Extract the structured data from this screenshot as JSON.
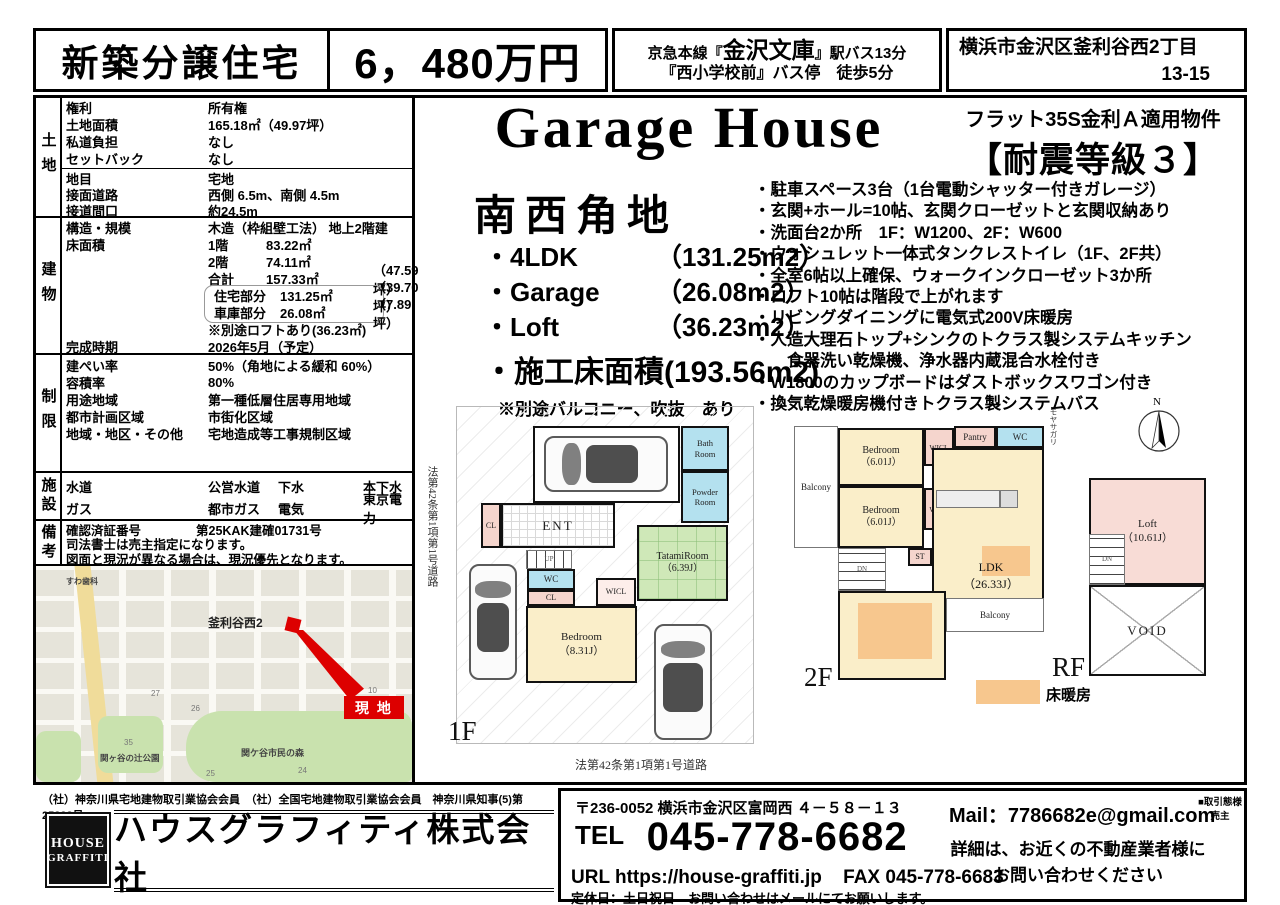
{
  "colors": {
    "accent_red": "#dd0000",
    "floor_heating_orange": "#f7c78e",
    "tatami_green": "#cfe8b8",
    "water_blue": "#b4e1ef",
    "closet_pink": "#f5d5cd",
    "loft_pink": "#f8dcd6"
  },
  "header": {
    "type_label": "新築分譲住宅",
    "price": "6，480万円",
    "access_pre": "京急本線『",
    "access_station": "金沢文庫",
    "access_post": "』駅バス13分",
    "access_line2": "『西小学校前』バス停　徒歩5分",
    "address_line1": "横浜市金沢区釜利谷西2丁目",
    "address_line2": "13-15"
  },
  "table": {
    "land": {
      "group": "土地",
      "rows": [
        {
          "label": "権利",
          "value": "所有権"
        },
        {
          "label": "土地面積",
          "value": "165.18㎡（49.97坪）"
        },
        {
          "label": "私道負担",
          "value": "なし"
        },
        {
          "label": "セットバック",
          "value": "なし"
        }
      ],
      "rows2": [
        {
          "label": "地目",
          "value": "宅地"
        },
        {
          "label": "接面道路",
          "value": "西側 6.5m、南側 4.5m"
        },
        {
          "label": "接道間口",
          "value": "約24.5m"
        }
      ]
    },
    "building": {
      "group": "建物",
      "rows": [
        {
          "label": "構造・規模",
          "value": "木造（枠組壁工法） 地上2階建"
        },
        {
          "label": "床面積",
          "sub": "1階",
          "value": "83.22㎡"
        },
        {
          "sub": "2階",
          "value": "74.11㎡"
        },
        {
          "sub": "合計",
          "value": "157.33㎡",
          "tsubo": "（47.59坪）"
        },
        {
          "sub": "住宅部分",
          "value": "131.25㎡",
          "tsubo": "（39.70坪）"
        },
        {
          "sub": "車庫部分",
          "value": "26.08㎡",
          "tsubo": "（7.89坪）"
        },
        {
          "value": "※別途ロフトあり(36.23㎡)"
        },
        {
          "label": "完成時期",
          "value": "2026年5月（予定）"
        }
      ]
    },
    "restrict": {
      "group": "制限",
      "rows": [
        {
          "label": "建ぺい率",
          "value": "50%（角地による緩和 60%）"
        },
        {
          "label": "容積率",
          "value": "80%"
        },
        {
          "label": "用途地域",
          "value": "第一種低層住居専用地域"
        },
        {
          "label": "都市計画区域",
          "value": "市街化区域"
        },
        {
          "label": "地域・地区・その他",
          "value": "宅地造成等工事規制区域"
        }
      ]
    },
    "facility": {
      "group": "施設",
      "rows": [
        {
          "l1": "水道",
          "v1": "公営水道",
          "l2": "下水",
          "v2": "本下水"
        },
        {
          "l1": "ガス",
          "v1": "都市ガス",
          "l2": "電気",
          "v2": "東京電力"
        }
      ]
    },
    "remarks": {
      "group": "備考",
      "cert_label": "確認済証番号",
      "cert_value": "第25KAK建確01731号",
      "line2": "司法書士は売主指定になります。",
      "line3": "図面と現況が異なる場合は、現況優先となります。"
    }
  },
  "map": {
    "dental": "すわ歯科",
    "district": "釜利谷西2",
    "site": "現 地",
    "park1": "関ヶ谷の辻公園",
    "park2": "関ケ谷市民の森",
    "n27": "27",
    "n26": "26",
    "n25": "25",
    "n24": "24",
    "n35": "35",
    "n10": "10"
  },
  "main": {
    "title": "Garage House",
    "corner": "南西角地",
    "specs": [
      {
        "name": "・4LDK",
        "area": "（131.25m2）"
      },
      {
        "name": "・Garage",
        "area": "（26.08m2）"
      },
      {
        "name": "・Loft",
        "area": "（36.23m2）"
      }
    ],
    "total": "・施工床面積(193.56m2)",
    "note": "※別途バルコニー、吹抜　あり",
    "flat35": "フラット35S金利Ａ適用物件",
    "seismic": "【耐震等級３】",
    "features": [
      "・駐車スペース3台（1台電動シャッター付きガレージ）",
      "・玄関+ホール=10帖、玄関クローゼットと玄関収納あり",
      "・洗面台2か所　1F：W1200、2F：W600",
      "・ウォシュレット一体式タンクレストイレ（1F、2F共）",
      "・全室6帖以上確保、ウォークインクローゼット3か所",
      "・ロフト10帖は階段で上がれます",
      "・リビングダイニングに電気式200V床暖房",
      "・人造大理石トップ+シンクのトクラス製システムキッチン",
      "　　食器洗い乾燥機、浄水器内蔵混合水栓付き",
      "・W1800のカップボードはダストボックスワゴン付き",
      "・換気乾燥暖房機付きトクラス製システムバス"
    ]
  },
  "plans": {
    "road_left": "法第42条第1項第1号道路",
    "road_bottom": "法第42条第1項第1号道路",
    "f1": "1F",
    "f2": "2F",
    "rf": "RF",
    "legend": "床暖房",
    "moyasagari": "モヤサガリ",
    "north": "N",
    "r1f": {
      "bath": "Bath\nRoom",
      "powder": "Powder\nRoom",
      "cl1": "CL",
      "ent": "ENT",
      "up": "UP",
      "wc": "WC",
      "cl2": "CL",
      "wicl": "WICL",
      "st": "ST",
      "tatami": "TatamiRoom\n（6.39J）",
      "bedroom": "Bedroom\n（8.31J）"
    },
    "r2f": {
      "balcony1": "Balcony",
      "bedroom1": "Bedroom\n（6.01J）",
      "wicl1": "WICL",
      "pantry": "Pantry",
      "wc": "WC",
      "bedroom2": "Bedroom\n（6.01J）",
      "wicl2": "WICL",
      "st": "ST",
      "ldk": "LDK\n（26.33J）",
      "balcony2": "Balcony",
      "up": "UP",
      "dn": "DN"
    },
    "rrf": {
      "loft": "Loft\n（10.61J）",
      "void": "VOID",
      "dn": "DN"
    }
  },
  "footer": {
    "memberships": "（社）神奈川県宅地建物取引業協会会員　（社）全国宅地建物取引業協会会員　神奈川県知事(5)第25238号",
    "logo1": "HOUSE",
    "logo2": "GRAFFITI",
    "company": "ハウスグラフィティ株式会社",
    "postal": "〒236-0052 横浜市金沢区富岡西 ４－５８－１３",
    "tel_label": "TEL",
    "tel": "045-778-6682",
    "url": "URL https://house-graffiti.jp",
    "fax": "FAX 045-778-6683",
    "holiday": "定休日：土日祝日　お問い合わせはメールにてお願いします。",
    "mail_label": "Mail：",
    "mail": "7786682e@gmail.com",
    "deal": "■取引態様\n売主",
    "inquiry": "詳細は、お近くの不動産業者様に\nお問い合わせください"
  }
}
